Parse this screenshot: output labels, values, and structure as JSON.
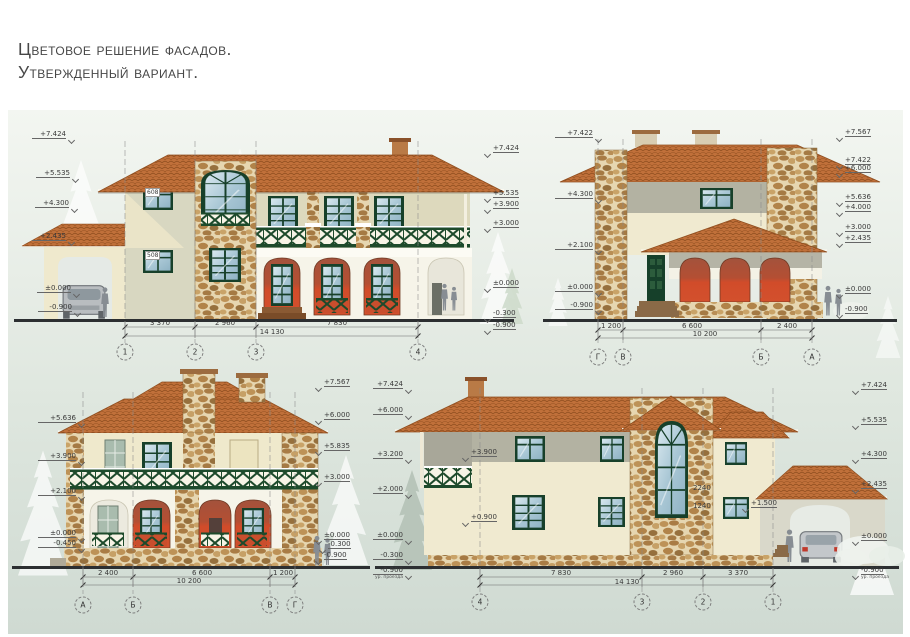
{
  "title": {
    "line1": "Цветовое решение фасадов.",
    "line2": "Утвержденный вариант."
  },
  "colors": {
    "roof_tile": "#c0703a",
    "wall_cream": "#f0ead0",
    "wall_olive": "#b3b2a2",
    "arch_red": "#d14c2a",
    "trim_green": "#1d4a2b",
    "stone_tan": "#b98d54"
  },
  "e1": {
    "marks_left": [
      "+7.424",
      "+5.535",
      "+4.300",
      "+2.435",
      "±0.000",
      "-0.900"
    ],
    "marks_right": [
      "+7.424",
      "+5.535",
      "+3.900",
      "+3.000",
      "±0.000",
      "-0.300",
      "-0.900"
    ],
    "window_tags": [
      "608",
      "508"
    ],
    "dims": [
      "3 370",
      "2 960",
      "7 830",
      "14 130"
    ],
    "axes": [
      "1",
      "2",
      "3",
      "4"
    ]
  },
  "e2": {
    "marks_left": [
      "+7.422",
      "+4.300",
      "+2.100",
      "±0.000",
      "-0.900"
    ],
    "marks_right": [
      "+7.567",
      "+7.422",
      "+6.000",
      "+5.636",
      "+4.000",
      "+3.000",
      "+2.435",
      "±0.000",
      "-0.900"
    ],
    "dims": [
      "1 200",
      "6 600",
      "2 400",
      "10 200"
    ],
    "axes": [
      "Г",
      "В",
      "Б",
      "А"
    ]
  },
  "e3": {
    "marks_left": [
      "+5.636",
      "+3.900",
      "+2.100",
      "±0.000",
      "-0.450"
    ],
    "marks_right": [
      "+7.567",
      "+6.000",
      "+5.835",
      "+3.000",
      "±0.000",
      "-0.300",
      "-0.900"
    ],
    "dims": [
      "2 400",
      "6 600",
      "1 200",
      "10 200"
    ],
    "axes": [
      "А",
      "Б",
      "В",
      "Г"
    ]
  },
  "e4": {
    "marks_left": [
      "+7.424",
      "+6.000",
      "+3.200",
      "+2.000",
      "±0.000",
      "-0.300",
      "-0.900"
    ],
    "marks_right": [
      "+7.424",
      "+5.535",
      "+4.300",
      "+2.435",
      "±0.000",
      "-0.900"
    ],
    "level_note": "ур. проезда",
    "inner_marks": [
      "+3.900",
      "+0.900",
      "2240",
      "1240",
      "+1.500"
    ],
    "dims": [
      "7 830",
      "2 960",
      "3 370",
      "14 130"
    ],
    "axes": [
      "4",
      "3",
      "2",
      "1"
    ]
  }
}
